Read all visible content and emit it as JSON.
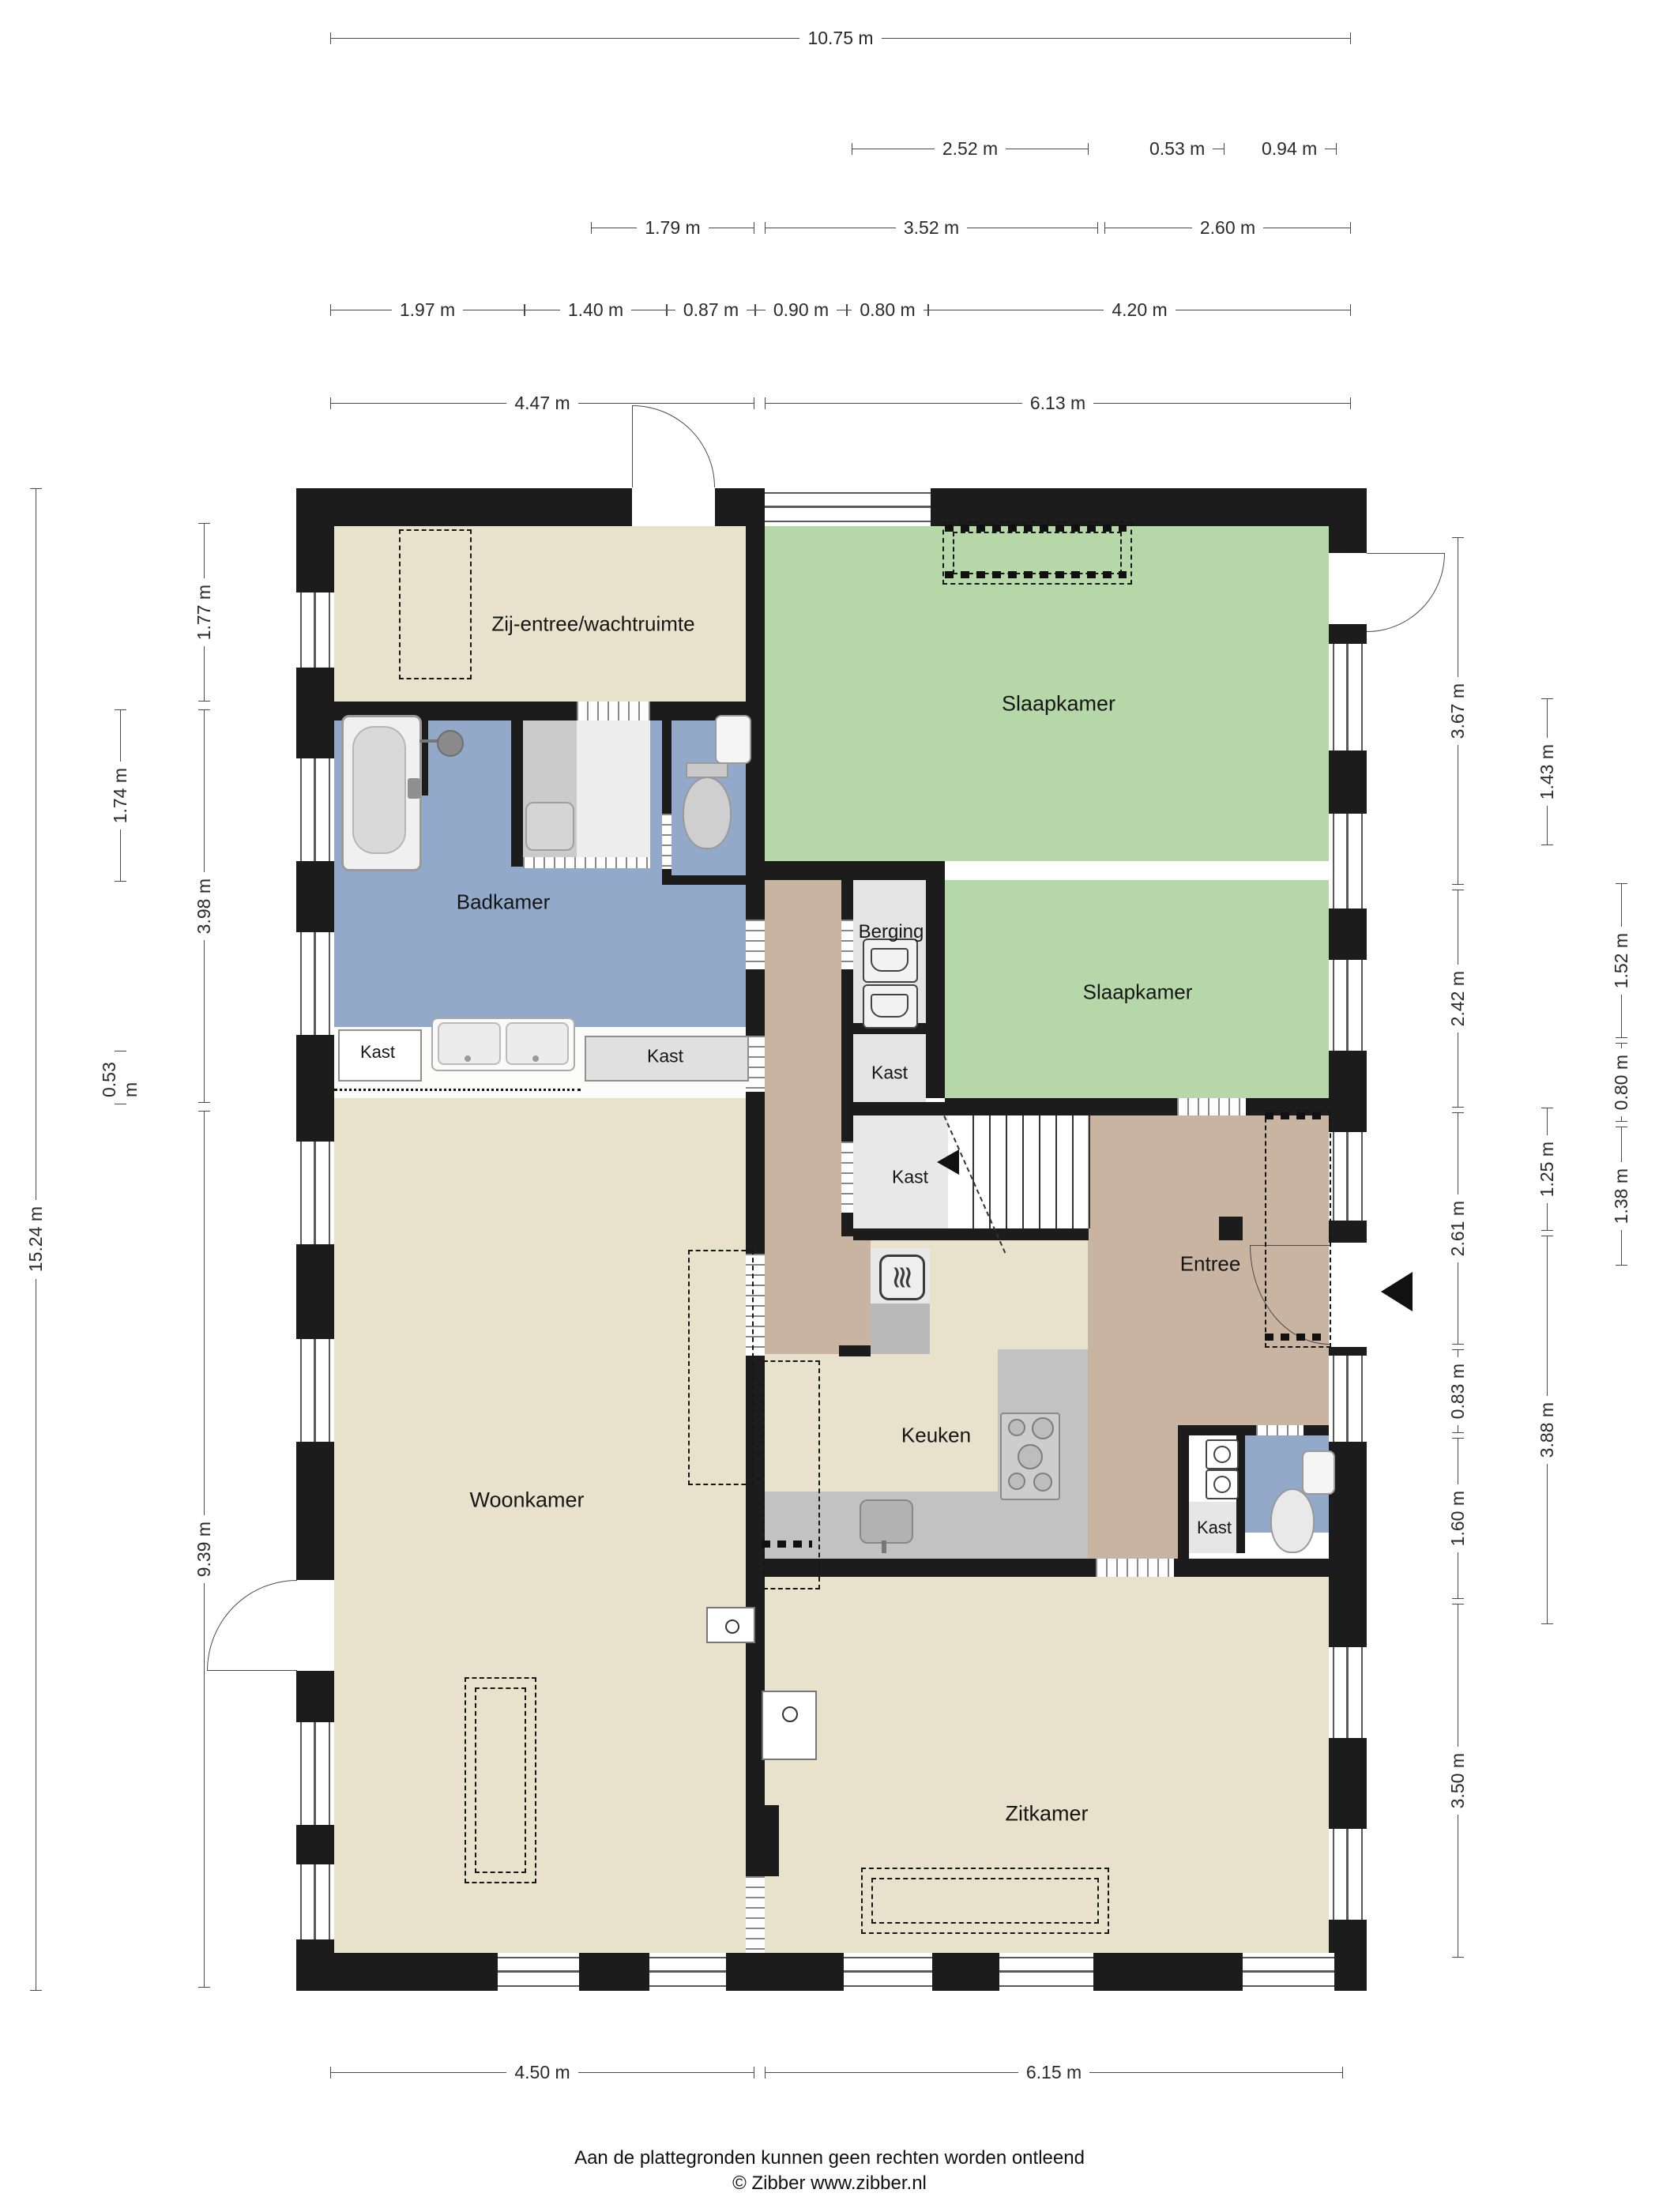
{
  "title": "Plattegrond begane grond",
  "rooms": {
    "zij_entree": "Zij-entree/wachtruimte",
    "slaapkamer1": "Slaapkamer",
    "badkamer": "Badkamer",
    "berging": "Berging",
    "slaapkamer2": "Slaapkamer",
    "kast1": "Kast",
    "kast2": "Kast",
    "kast3": "Kast",
    "kast4": "Kast",
    "kast5": "Kast",
    "woonkamer": "Woonkamer",
    "keuken": "Keuken",
    "entree": "Entree",
    "zitkamer": "Zitkamer"
  },
  "dimensions": {
    "top": {
      "total": "10.75 m",
      "row2": [
        "2.52 m",
        "0.53 m",
        "0.94 m"
      ],
      "row3": [
        "1.79 m",
        "3.52 m",
        "2.60 m"
      ],
      "row4": [
        "1.97 m",
        "1.40 m",
        "0.87 m",
        "0.90 m",
        "0.80 m",
        "4.20 m"
      ],
      "row5": [
        "4.47 m",
        "6.13 m"
      ]
    },
    "bottom": [
      "4.50 m",
      "6.15 m"
    ],
    "left": {
      "total": "15.24 m",
      "inner": [
        "1.77 m",
        "3.98 m",
        "9.39 m"
      ],
      "mid": [
        "1.74 m",
        "0.53 m"
      ]
    },
    "right": {
      "inner": [
        "3.67 m",
        "2.42 m",
        "2.61 m",
        "0.83 m",
        "1.60 m",
        "3.50 m"
      ],
      "mid": [
        "1.43 m",
        "1.25 m",
        "3.88 m"
      ],
      "outer": [
        "1.52 m",
        "0.80 m",
        "1.38 m"
      ]
    }
  },
  "footer": {
    "line1": "Aan de plattegronden kunnen geen rechten worden ontleend",
    "line2": "© Zibber www.zibber.nl"
  },
  "colors": {
    "floor_beige": "#e8e1cb",
    "floor_green": "#b6d7a7",
    "floor_blue": "#92a9c9",
    "floor_tan": "#c8b4a1",
    "floor_gray": "#e5e5e5",
    "counter_gray": "#c2c2c2",
    "wall_black": "#1c1c1c",
    "dim_line": "#4a4a4a"
  }
}
